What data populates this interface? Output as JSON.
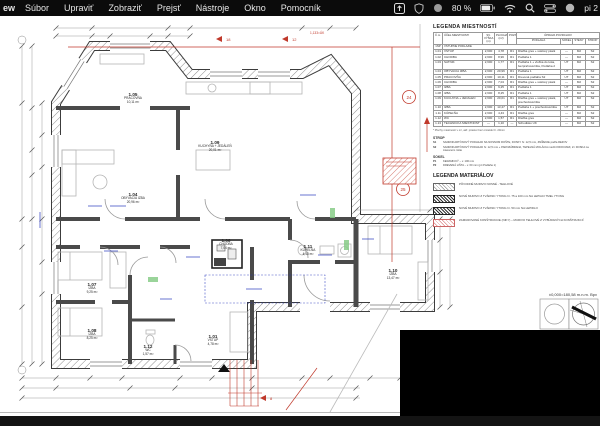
{
  "menubar": {
    "app_fragment": "ew",
    "items": [
      "Súbor",
      "Upraviť",
      "Zobraziť",
      "Prejsť",
      "Nástroje",
      "Okno",
      "Pomocník"
    ],
    "battery": "80 %",
    "clock": "pi 2"
  },
  "colors": {
    "markup_red": "#c0392b",
    "annotation_blue": "#2233bb",
    "highlight_green": "#88cc88"
  },
  "legend_rooms": {
    "title": "LEGENDA MIESTNOSTÍ",
    "headers": [
      "Č.m.",
      "ÚČEL MIESTNOSTI",
      "SV. VÝŠKA (m)",
      "PLOCHA (m²)",
      "POZN.",
      "PODLAHA",
      "SOKEL",
      "STENY",
      "STROP"
    ],
    "surface_group": "ÚPRAVA POVRCHOV",
    "level": {
      "num": "1NP",
      "name": "VSTUPNÉ PODLAŽIE"
    },
    "rows": [
      {
        "num": "1.01",
        "name": "VSTUP",
        "height": "2,600",
        "area": "4,78",
        "note": "R1",
        "floor": "Dlažba gres + soklový pásik",
        "sokel": "—",
        "steny": "M2",
        "strop": "S2"
      },
      {
        "num": "1.02",
        "name": "CHODBA",
        "height": "2,600",
        "area": "8,96",
        "note": "R1",
        "floor": "Podlaha 1",
        "sokel": "—",
        "steny": "M2",
        "strop": "S2"
      },
      {
        "num": "1.03",
        "name": "ŠATNÍK",
        "height": "2,600",
        "area": "1,77",
        "note": "R1",
        "floor": "Podlaha 1 + vložka do kúta, bezprahová lišta, Podlaha 2",
        "sokel": "UT",
        "steny": "M2",
        "strop": "S2"
      },
      {
        "num": "1.04",
        "name": "OBÝVACIA IZBA",
        "height": "2,600",
        "area": "20,96",
        "note": "R1",
        "floor": "Podlaha 1",
        "sokel": "UT",
        "steny": "M2",
        "strop": "S2"
      },
      {
        "num": "1.05",
        "name": "PRACOVŇA",
        "height": "2,600",
        "area": "10,11",
        "note": "R1",
        "floor": "Drevená podlaha S2",
        "sokel": "UT",
        "steny": "M2",
        "strop": "S2"
      },
      {
        "num": "1.06",
        "name": "CHODBA",
        "height": "2,600",
        "area": "7,04",
        "note": "R1",
        "floor": "Dlažba gres + soklový pásik",
        "sokel": "—",
        "steny": "M2",
        "strop": "S2"
      },
      {
        "num": "1.07",
        "name": "IZBA",
        "height": "2,600",
        "area": "9,25",
        "note": "R1",
        "floor": "Podlaha 1",
        "sokel": "UT",
        "steny": "M2",
        "strop": "S2"
      },
      {
        "num": "1.08",
        "name": "IZBA",
        "height": "2,600",
        "area": "8,25",
        "note": "R1",
        "floor": "Podlaha 1",
        "sokel": "UT",
        "steny": "M2",
        "strop": "S2"
      },
      {
        "num": "1.09",
        "name": "KUCHYŇA + JEDÁLEŇ",
        "height": "2,600",
        "area": "20,01",
        "note": "R1",
        "floor": "Dlažba gres + soklový pásik, prechodová lišta",
        "sokel": "UT",
        "steny": "M2",
        "strop": "S2"
      },
      {
        "num": "1.10",
        "name": "IZBA",
        "height": "2,600",
        "area": "13,47",
        "note": "R1",
        "floor": "Podlaha 1 + prechodová lišta",
        "sokel": "UT",
        "steny": "M2",
        "strop": "S2"
      },
      {
        "num": "1.11",
        "name": "KÚPEĽŇA",
        "height": "2,600",
        "area": "4,43",
        "note": "R1",
        "floor": "Dlažba gres",
        "sokel": "—",
        "steny": "M2",
        "strop": "S2"
      },
      {
        "num": "1.12",
        "name": "WC",
        "height": "2,600",
        "area": "1,57",
        "note": "R1",
        "floor": "Dlažba gres",
        "sokel": "—",
        "steny": "M2",
        "strop": "S2"
      },
      {
        "num": "1.13",
        "name": "TECHNICKÁ MIESTNOSŤ",
        "height": "—",
        "area": "1,10",
        "note": "—",
        "floor": "Schodisko ÚK",
        "sokel": "—",
        "steny": "M2",
        "strop": "S2"
      }
    ],
    "footnote": "* Plochy miestností v m², atď. priestor bez omietok hr. 20mm"
  },
  "notes": {
    "strop_title": "STROP",
    "strop_items": [
      {
        "code": "S1",
        "text": "SADROKARTÓNOVÝ PODHĽAD NA NOSNOM ROŠTE, DOSKY hr. 12,5 mm, ZNÍŽENIE podľa REZOV"
      },
      {
        "code": "S2",
        "text": "SADROKARTÓNOVÝ PODHĽAD hr. 12,5 mm + PAROZÁBRANA, TEPELNÁ IZOLÁCIA medzi KROKVAMI, 2× DOSKA na závesnom rošte"
      }
    ],
    "sokel_title": "SOKEL",
    "sokel_items": [
      {
        "code": "P1",
        "text": "KERAMICKÝ – v. 100 mm"
      },
      {
        "code": "P2",
        "text": "DREVENÁ LIŠTA – v. 60 mm (pri Podlahe 1)"
      }
    ]
  },
  "legend_materials": {
    "title": "LEGENDA MATERIÁLOV",
    "items": [
      {
        "pattern": "gray-diagonal-hatch",
        "label": "PÔVODNÉ MURIVO NOSNÉ - TEHLOVÉ"
      },
      {
        "pattern": "dark-dense-hatch",
        "label": "NOVÉ MURIVO Z TVÁRNIC YTONG hr. 75 a 100 mm NA LEPIACI TMEL YTONG"
      },
      {
        "pattern": "dark-dense-hatch",
        "label": "NOVÉ MURIVO Z TVÁRNIC YTONG hr. 50 mm NA LEPIDLO"
      },
      {
        "pattern": "red-diagonal-hatch",
        "label": "ZAMUROVANÉ KONŠTRUKCIE (NIKY) – MURIVO TEHLOVÉ Z VYBÚRANÝCH KONŠTRUKCIÍ"
      }
    ]
  },
  "plan": {
    "elevation": "±0,000=180,58 m.n.m. Bpv",
    "markup": {
      "circle_a": "24",
      "circle_b": "25",
      "flag_a": "18",
      "flag_b": "12",
      "flag_c": "8",
      "note": "1,133=ÚK"
    },
    "rooms": [
      {
        "id": "1.05",
        "name": "PRACOVŇA",
        "area": "10,11 m²"
      },
      {
        "id": "1.09",
        "name": "KUCHYŇA + JEDÁLEŇ",
        "area": "20,01 m²"
      },
      {
        "id": "1.04",
        "name": "OBÝVACIA IZBA",
        "area": "20,96 m²"
      },
      {
        "id": "1.06",
        "name": "CHODBA",
        "area": "7,04 m²"
      },
      {
        "id": "1.11",
        "name": "KÚPEĽŇA",
        "area": "4,43 m²"
      },
      {
        "id": "1.07",
        "name": "IZBA",
        "area": "9,25 m²"
      },
      {
        "id": "1.08",
        "name": "IZBA",
        "area": "8,25 m²"
      },
      {
        "id": "1.12",
        "name": "WC",
        "area": "1,57 m²"
      },
      {
        "id": "1.01",
        "name": "VSTUP",
        "area": "4,78 m²"
      },
      {
        "id": "1.10",
        "name": "IZBA",
        "area": "13,47 m²"
      }
    ]
  }
}
